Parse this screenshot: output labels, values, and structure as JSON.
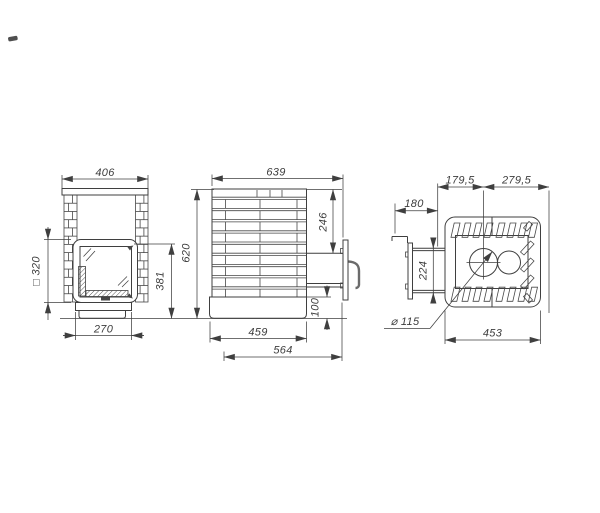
{
  "canvas": {
    "background": "#ffffff",
    "line_color": "#3f3f3f"
  },
  "views": {
    "front": {
      "dims": {
        "top_width": "406",
        "door_square": "□ 320",
        "door_height": "381",
        "base_width": "270"
      }
    },
    "side": {
      "dims": {
        "overall_depth": "639",
        "overall_height": "620",
        "door_offset": "246",
        "base_height": "100",
        "body_depth": "459",
        "depth_with_door": "564"
      }
    },
    "top": {
      "dims": {
        "front_to_flue_center": "179,5",
        "flue_center_to_back": "279,5",
        "door_handle_depth": "180",
        "tunnel_width": "224",
        "flue_diameter": "⌀ 115",
        "body_width": "453"
      }
    }
  }
}
